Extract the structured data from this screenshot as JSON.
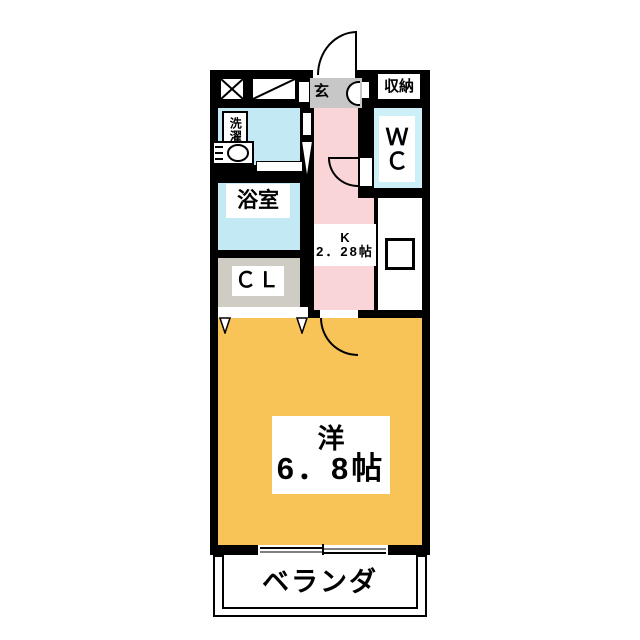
{
  "plan": {
    "title": "1K apartment floor plan",
    "storage_label": "収納",
    "entrance_label": "玄",
    "laundry_label": "洗濯",
    "bathroom_label": "浴室",
    "closet_label": "ＣＬ",
    "wc_line1": "Ｗ",
    "wc_line2": "Ｃ",
    "kitchen_line1": "K",
    "kitchen_line2": "2．28帖",
    "room_line1": "洋",
    "room_line2": "6．8帖",
    "veranda_label": "ベランダ"
  },
  "colors": {
    "wall": "#000000",
    "water_rooms": "#c3eaf4",
    "wc": "#cdeff8",
    "kitchen": "#f9d5d8",
    "western_room": "#f8c458",
    "closet": "#cfccc3",
    "entrance": "#c7c7c7",
    "background": "#ffffff"
  }
}
